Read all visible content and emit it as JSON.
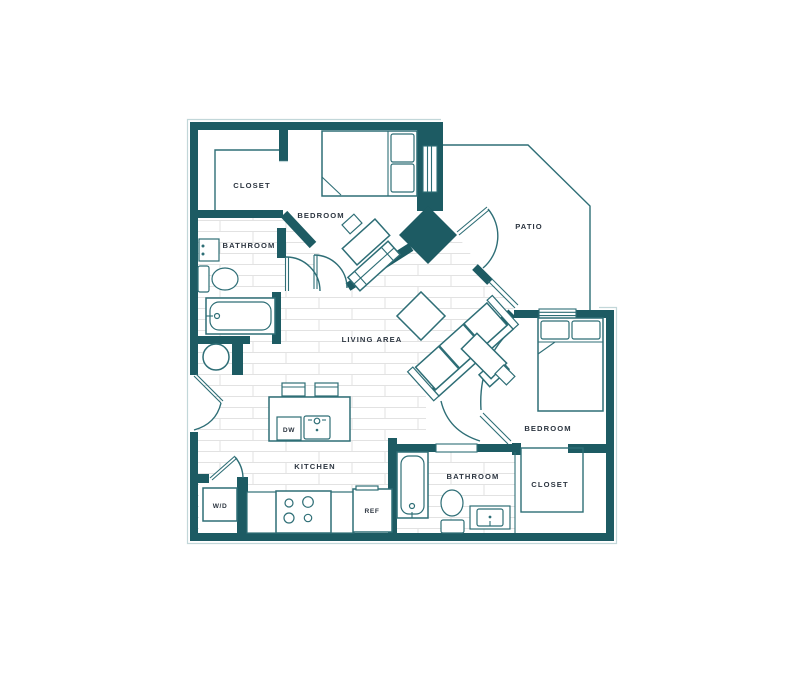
{
  "labels": {
    "closet_top": "CLOSET",
    "bedroom_top": "BEDROOM",
    "patio": "PATIO",
    "bathroom_left": "BATHROOM",
    "living": "LIVING AREA",
    "kitchen": "KITCHEN",
    "dw": "DW",
    "wd": "W/D",
    "ref": "REF",
    "bathroom_bottom": "BATHROOM",
    "closet_bottom": "CLOSET",
    "bedroom_right": "BEDROOM"
  },
  "colors": {
    "wall": "#1d5b63",
    "line": "#2e6e76",
    "light": "#c2d7d9",
    "text": "#2c3540",
    "floor": "#e2e2e2",
    "bg": "#ffffff"
  }
}
